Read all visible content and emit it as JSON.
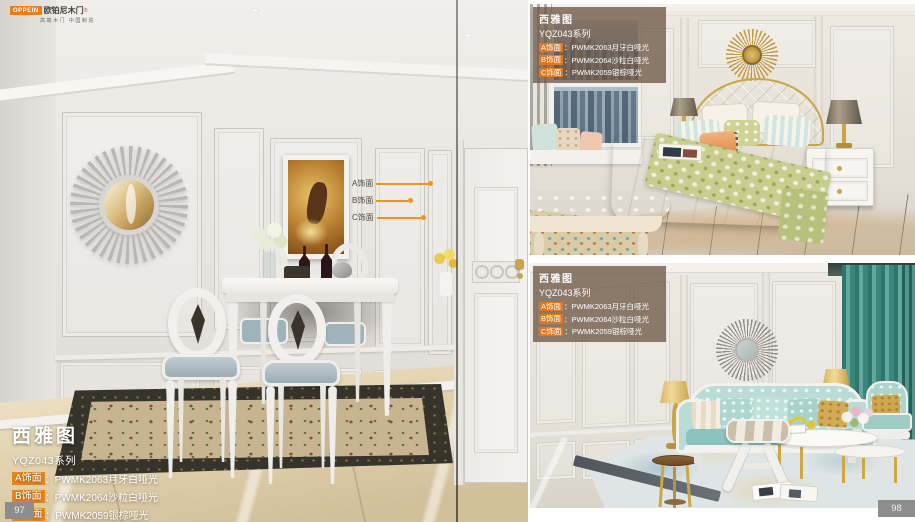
{
  "accent": "#f0931f",
  "brand": {
    "badge": "OPPEIN",
    "name": "欧铂尼木门",
    "reg": "®",
    "tagline": "高端木门 中国制造"
  },
  "product": {
    "title": "西雅图",
    "series": "YQZ043系列",
    "finishes": [
      {
        "tag": "A饰面",
        "sep": "：",
        "value": "PWMK2063月牙白哑光"
      },
      {
        "tag": "B饰面",
        "sep": "：",
        "value": "PWMK2064沙粒白哑光"
      },
      {
        "tag": "C饰面",
        "sep": "：",
        "value": "PWMK2059银棕哑光"
      }
    ]
  },
  "callouts": [
    {
      "label": "A饰面"
    },
    {
      "label": "B饰面"
    },
    {
      "label": "C饰面"
    }
  ],
  "pages": {
    "left_number": "97",
    "right_number": "98"
  }
}
